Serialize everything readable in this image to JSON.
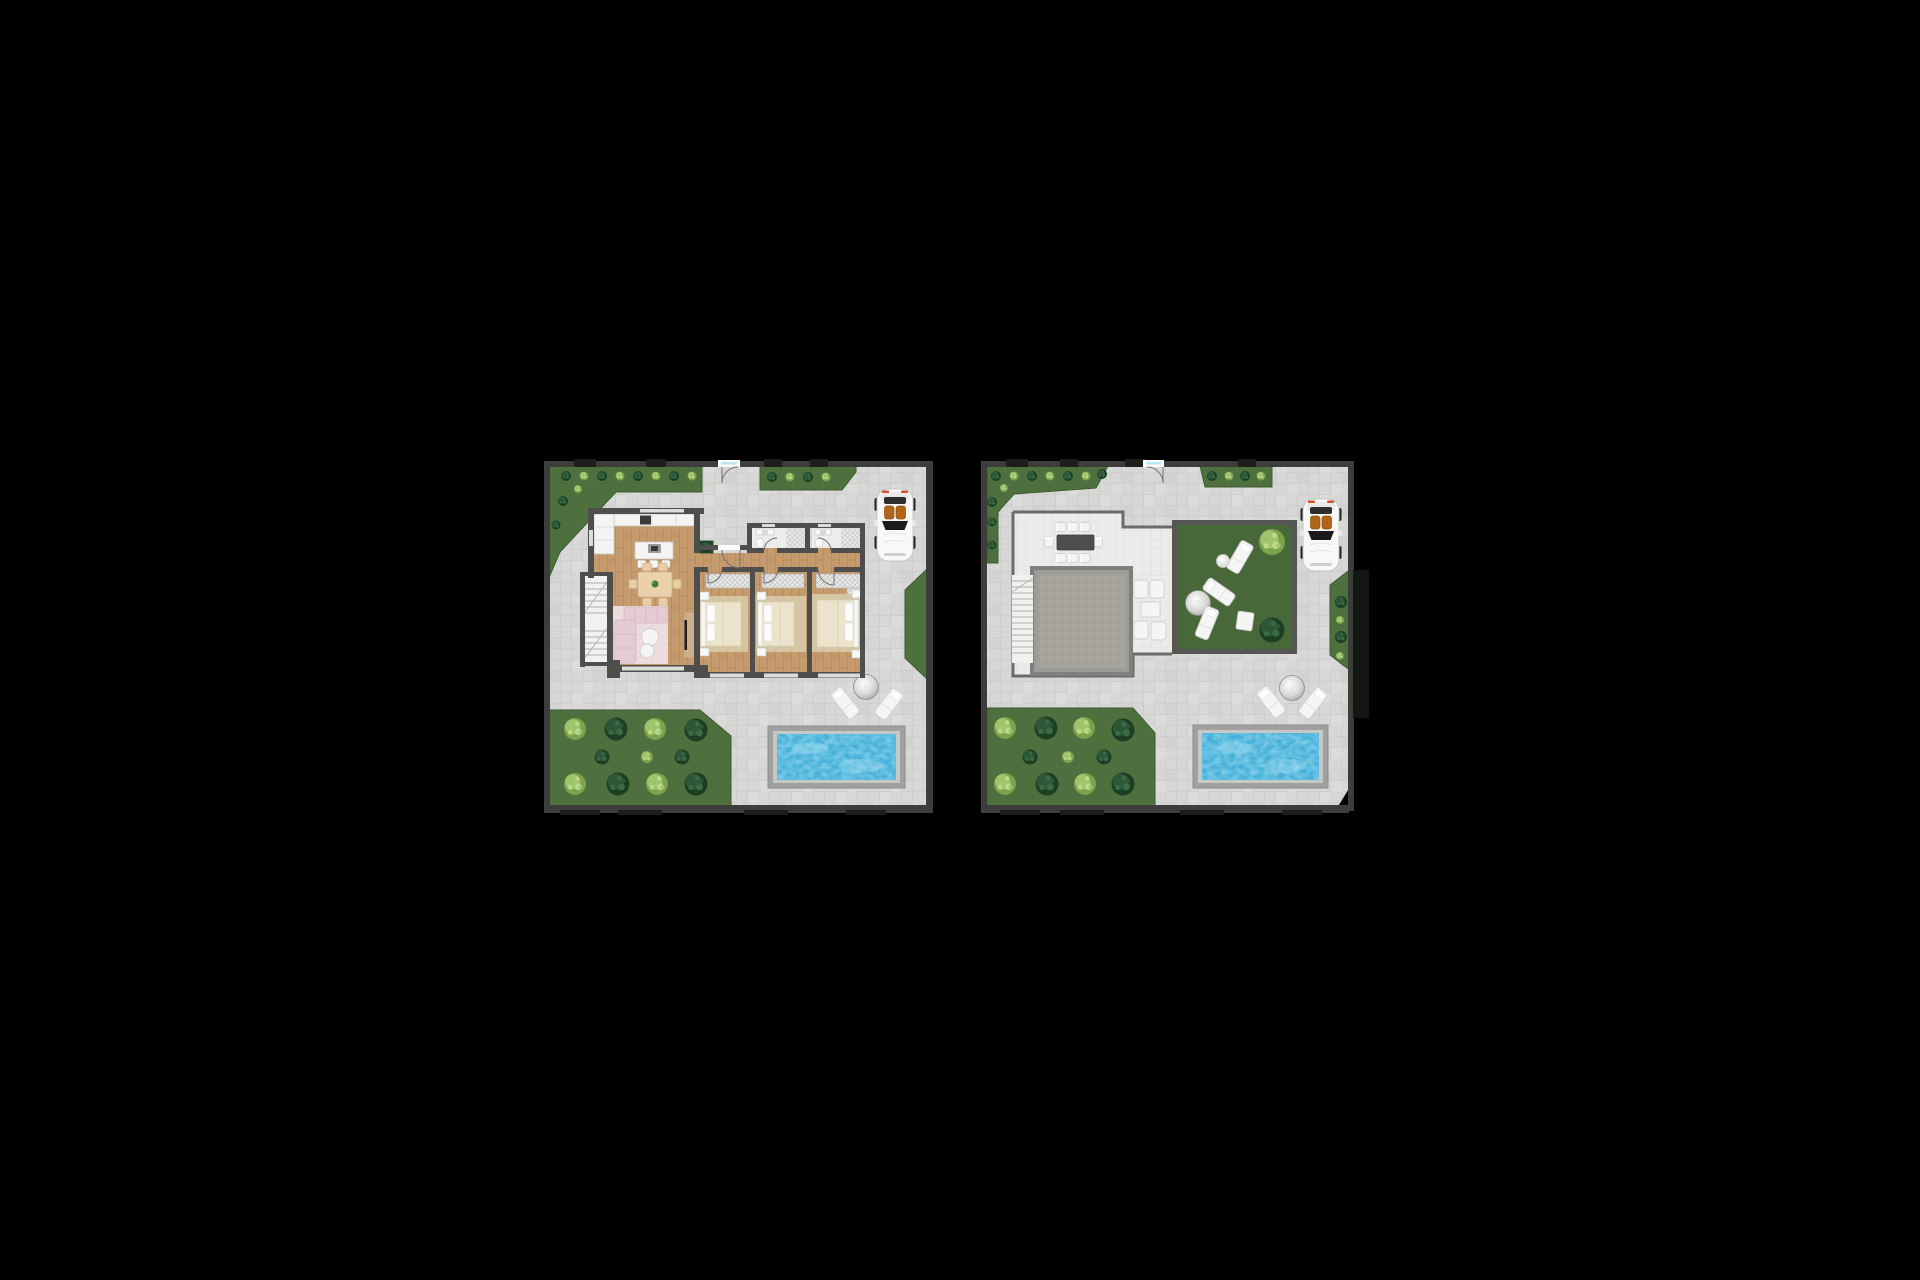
{
  "scene": {
    "type": "top-down architectural floor plan rendering, two plans side by side",
    "background_color": "#000000",
    "image_width": 1920,
    "image_height": 1280
  },
  "plans": [
    {
      "id": "ground-floor",
      "label": "Ground floor villa plan with driveway, pool and garden",
      "features": [
        "entry gate",
        "kitchen with wall counter and island with stools",
        "dining table for six with plant centerpiece",
        "L-shaped sofa with round coffee tables",
        "TV sideboard",
        "staircase",
        "hallway",
        "three bedrooms with double beds and built-in wardrobes",
        "two bathrooms",
        "courtyard planter",
        "white convertible car on driveway",
        "round tree with two sun loungers",
        "rectangular swimming pool",
        "garden with shrubs",
        "perimeter planting strips"
      ]
    },
    {
      "id": "roof-terrace",
      "label": "Roof terrace plan with driveway, pool and garden",
      "features": [
        "entry gate",
        "roof terrace deck",
        "outdoor dining table for eight",
        "skylight over stairwell",
        "staircase",
        "four lounge armchairs with side table",
        "roof lawn with three sun loungers, ball pouf and square pouf",
        "two lawn shrubs",
        "white convertible car on driveway",
        "round tree with two sun loungers",
        "rectangular swimming pool",
        "garden with shrubs",
        "perimeter planting strips"
      ]
    }
  ],
  "palette": {
    "background": "#000000",
    "pavement": "#d7d7d5",
    "pavement_line": "#c6c6c4",
    "pavement_light": "#e3e3e1",
    "terrace": "#ebebe9",
    "terrace_line": "#dbdbd9",
    "garden": "#4e6f3e",
    "lawn": "#486839",
    "garden_edge": "#3e5a32",
    "bush_dark": "#1c3f24",
    "bush_dark_hi": "#2d5737",
    "bush_light": "#7ba24c",
    "bush_light_hi": "#9fc46c",
    "boundary_wall": "#3d3d3b",
    "pier_dark": "#1d1d1b",
    "house_wall": "#4e4e4c",
    "parapet": "#6b6b69",
    "lawn_wall": "#565654",
    "dark_hedge": "#121811",
    "wood": "#c59b6e",
    "wood_line": "#b2875b",
    "bath_floor": "#ececea",
    "stair_floor": "#f1f1ef",
    "stair_line": "#b0b0ae",
    "counter": "#f4f4f2",
    "counter_line": "#c9c9c7",
    "island_hob": "#3a3a38",
    "table_tan": "#eccfab",
    "chair_tan": "#e9cda9",
    "sofa": "#e5ccd2",
    "rug_pink": "#ecdcdd",
    "rug_beige": "#d4c6a3",
    "bed_cream": "#ebe3cb",
    "pillow": "#fcfcfa",
    "headboard": "#f6f6f4",
    "fixture": "#f8f8f6",
    "fixture_line": "#c8c8c6",
    "white_furniture": "#f5f5f3",
    "white_furniture_line": "#cfcfcd",
    "door_arc": "#6f6f6d",
    "glass": "#b8e6f2",
    "door_white": "#fbfbf9",
    "cabinet_wood": "#cbb089",
    "tv": "#1e1e1c",
    "planter": "#2a4a26",
    "skylight_frame": "#7f7f7d",
    "skylight_mid": "#9b9b99",
    "skylight": "#a8a59f",
    "skylight_line": "#97948e",
    "pool_deck": "#a0a09e",
    "pool_rim": "#c7c7c5",
    "pool_water": "#2aa3d3",
    "pool_water_light": "#8fdcf0",
    "dome_edge": "#8d8d8b",
    "car_body": "#f8f8f6",
    "car_line": "#c6c6c4",
    "car_seat": "#b06418",
    "car_glass": "#1a1a1a",
    "car_top": "#2e2e2c",
    "car_light_red": "#d94f2b"
  }
}
